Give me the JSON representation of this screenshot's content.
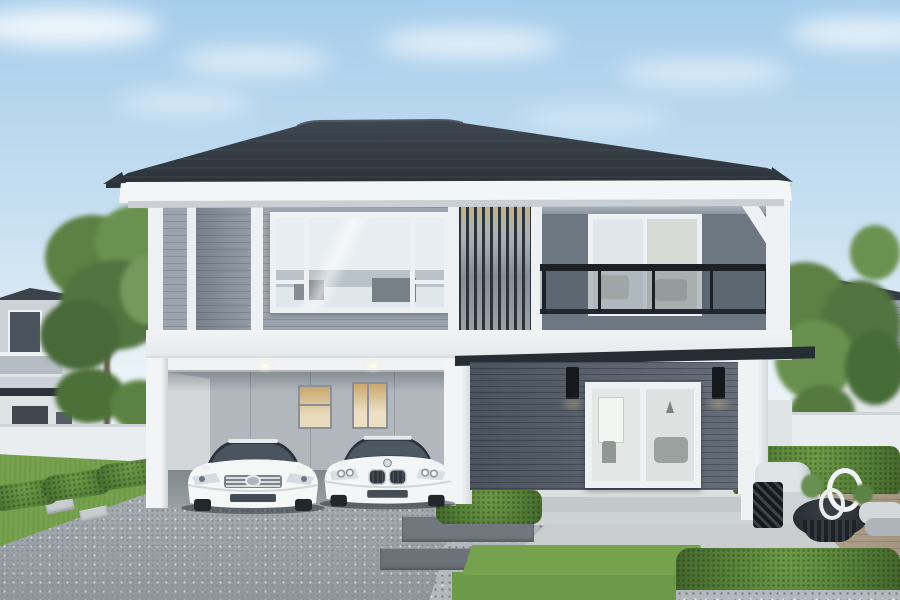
{
  "scene": {
    "type": "architectural-render",
    "description": "Photorealistic rendering of a modern two-storey detached house with charcoal hip roof, grey horizontal siding, vertical timber louvre screen, glass-railed balcony, double carport with two white sedans, landscaped garden with trimmed hedges, lawn squares, gravel beds and a timber patio deck with outdoor lounge furniture under a blue sky.",
    "labels": {
      "sky": "blue sky with soft clouds",
      "main_house": "modern two-storey house",
      "roof": "charcoal hip roof with white fascia",
      "upper_floor": "upper floor with picture window, louvre screen and balcony",
      "louvre": "vertical slat louvre screen with warm light",
      "balcony": "recessed balcony with black-framed glass railing",
      "carport": "open double carport with downlights",
      "entrance": "glass double door entrance with black wall sconces",
      "awning": "dark steel awning over entrance",
      "left_neighbor_house": "neighbouring house on the left",
      "right_neighbor_house": "neighbouring house on the right",
      "fence": "white boundary wall",
      "driveway": "speckled concrete driveway",
      "garden": "landscaped garden with hedges, lawn and gravel",
      "patio": "timber deck patio with lounge chair, lattice side table, round coffee table and cushions",
      "trees": "green garden trees"
    },
    "vehicles": [
      {
        "label": "white Toyota sedan parked in carport",
        "color": "white"
      },
      {
        "label": "white BMW sedan parked in carport",
        "color": "white"
      }
    ]
  },
  "colors": {
    "sky-top": "#a6cdeb",
    "sky-mid": "#c9e0f1",
    "sky-low": "#e9f2f7",
    "cloud": "#ffffff",
    "roof-dark": "#343b43",
    "fascia-white": "#f3f6f7",
    "siding-gray": "#9ca5ae",
    "balcony-wall": "#6d7781",
    "railing-black": "#1d2126",
    "louver-dark": "#2d333a",
    "louver-warm": "#d3ad74",
    "glass-light": "#dfe7eb",
    "band-white": "#f1f4f5",
    "dark-siding": "#59626d",
    "carport-wall": "#b1b7bd",
    "warm-window": "#c9a76e",
    "column-white": "#eef1f3",
    "awning-dark": "#272d34",
    "driveway": "#9fa6ac",
    "concrete": "#ccd1d3",
    "deck-wood": "#a89a85",
    "grass": "#76a14d",
    "grass-square": "#6d9a48",
    "hedge": "#567f38",
    "hedge-light": "#6e9a47",
    "gravel": "#b2b8bd",
    "paver": "#70777d",
    "fence-white": "#e9edf0",
    "tree-green": "#5d7d47",
    "car-white": "#f4f6f6"
  }
}
